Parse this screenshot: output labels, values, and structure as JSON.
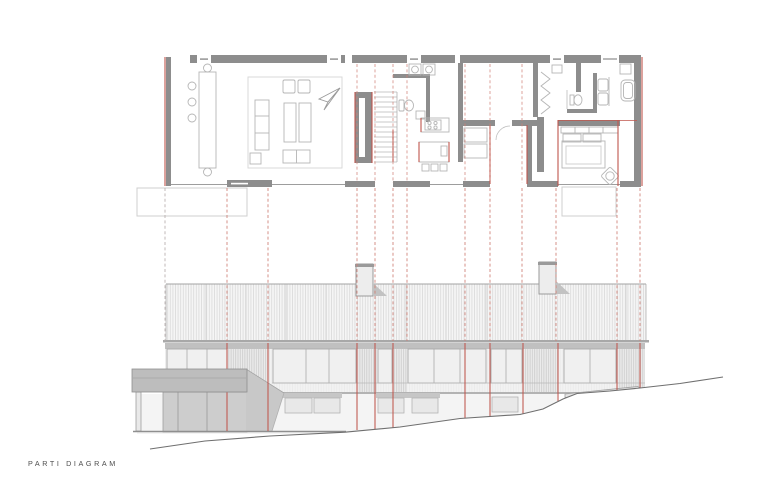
{
  "title": {
    "label": "PARTI DIAGRAM"
  },
  "colors": {
    "accent_red": "#c0564d",
    "dashed_red": "#d08076",
    "dashed_gray": "#b9b0ae",
    "wall_gray": "#8d8d8d",
    "furniture_gray": "#b5b5b5",
    "roof_hatch": "#dadada",
    "canopy_gray": "#bdbdbd",
    "ground_gray": "#6f6f6f",
    "paper": "#ffffff"
  },
  "projection_lines": {
    "plan_dashed": [
      357,
      375,
      393,
      407,
      465,
      490,
      522
    ],
    "section_dashed": [
      {
        "x": 165,
        "tone": "gray"
      },
      {
        "x": 227,
        "tone": "red"
      },
      {
        "x": 268,
        "tone": "red"
      },
      {
        "x": 357,
        "tone": "red"
      },
      {
        "x": 375,
        "tone": "red"
      },
      {
        "x": 393,
        "tone": "red"
      },
      {
        "x": 407,
        "tone": "red"
      },
      {
        "x": 465,
        "tone": "red"
      },
      {
        "x": 490,
        "tone": "red"
      },
      {
        "x": 522,
        "tone": "red"
      },
      {
        "x": 556,
        "tone": "red"
      },
      {
        "x": 617,
        "tone": "red"
      },
      {
        "x": 640,
        "tone": "red"
      }
    ],
    "elevation_solid": [
      {
        "x": 227,
        "y2": 431
      },
      {
        "x": 268,
        "y2": 431
      },
      {
        "x": 357,
        "y2": 430
      },
      {
        "x": 375,
        "y2": 429
      },
      {
        "x": 393,
        "y2": 428
      },
      {
        "x": 465,
        "y2": 418
      },
      {
        "x": 490,
        "y2": 416
      },
      {
        "x": 523,
        "y2": 414
      },
      {
        "x": 558,
        "y2": 401
      },
      {
        "x": 617,
        "y2": 390
      },
      {
        "x": 640,
        "y2": 388
      }
    ]
  }
}
